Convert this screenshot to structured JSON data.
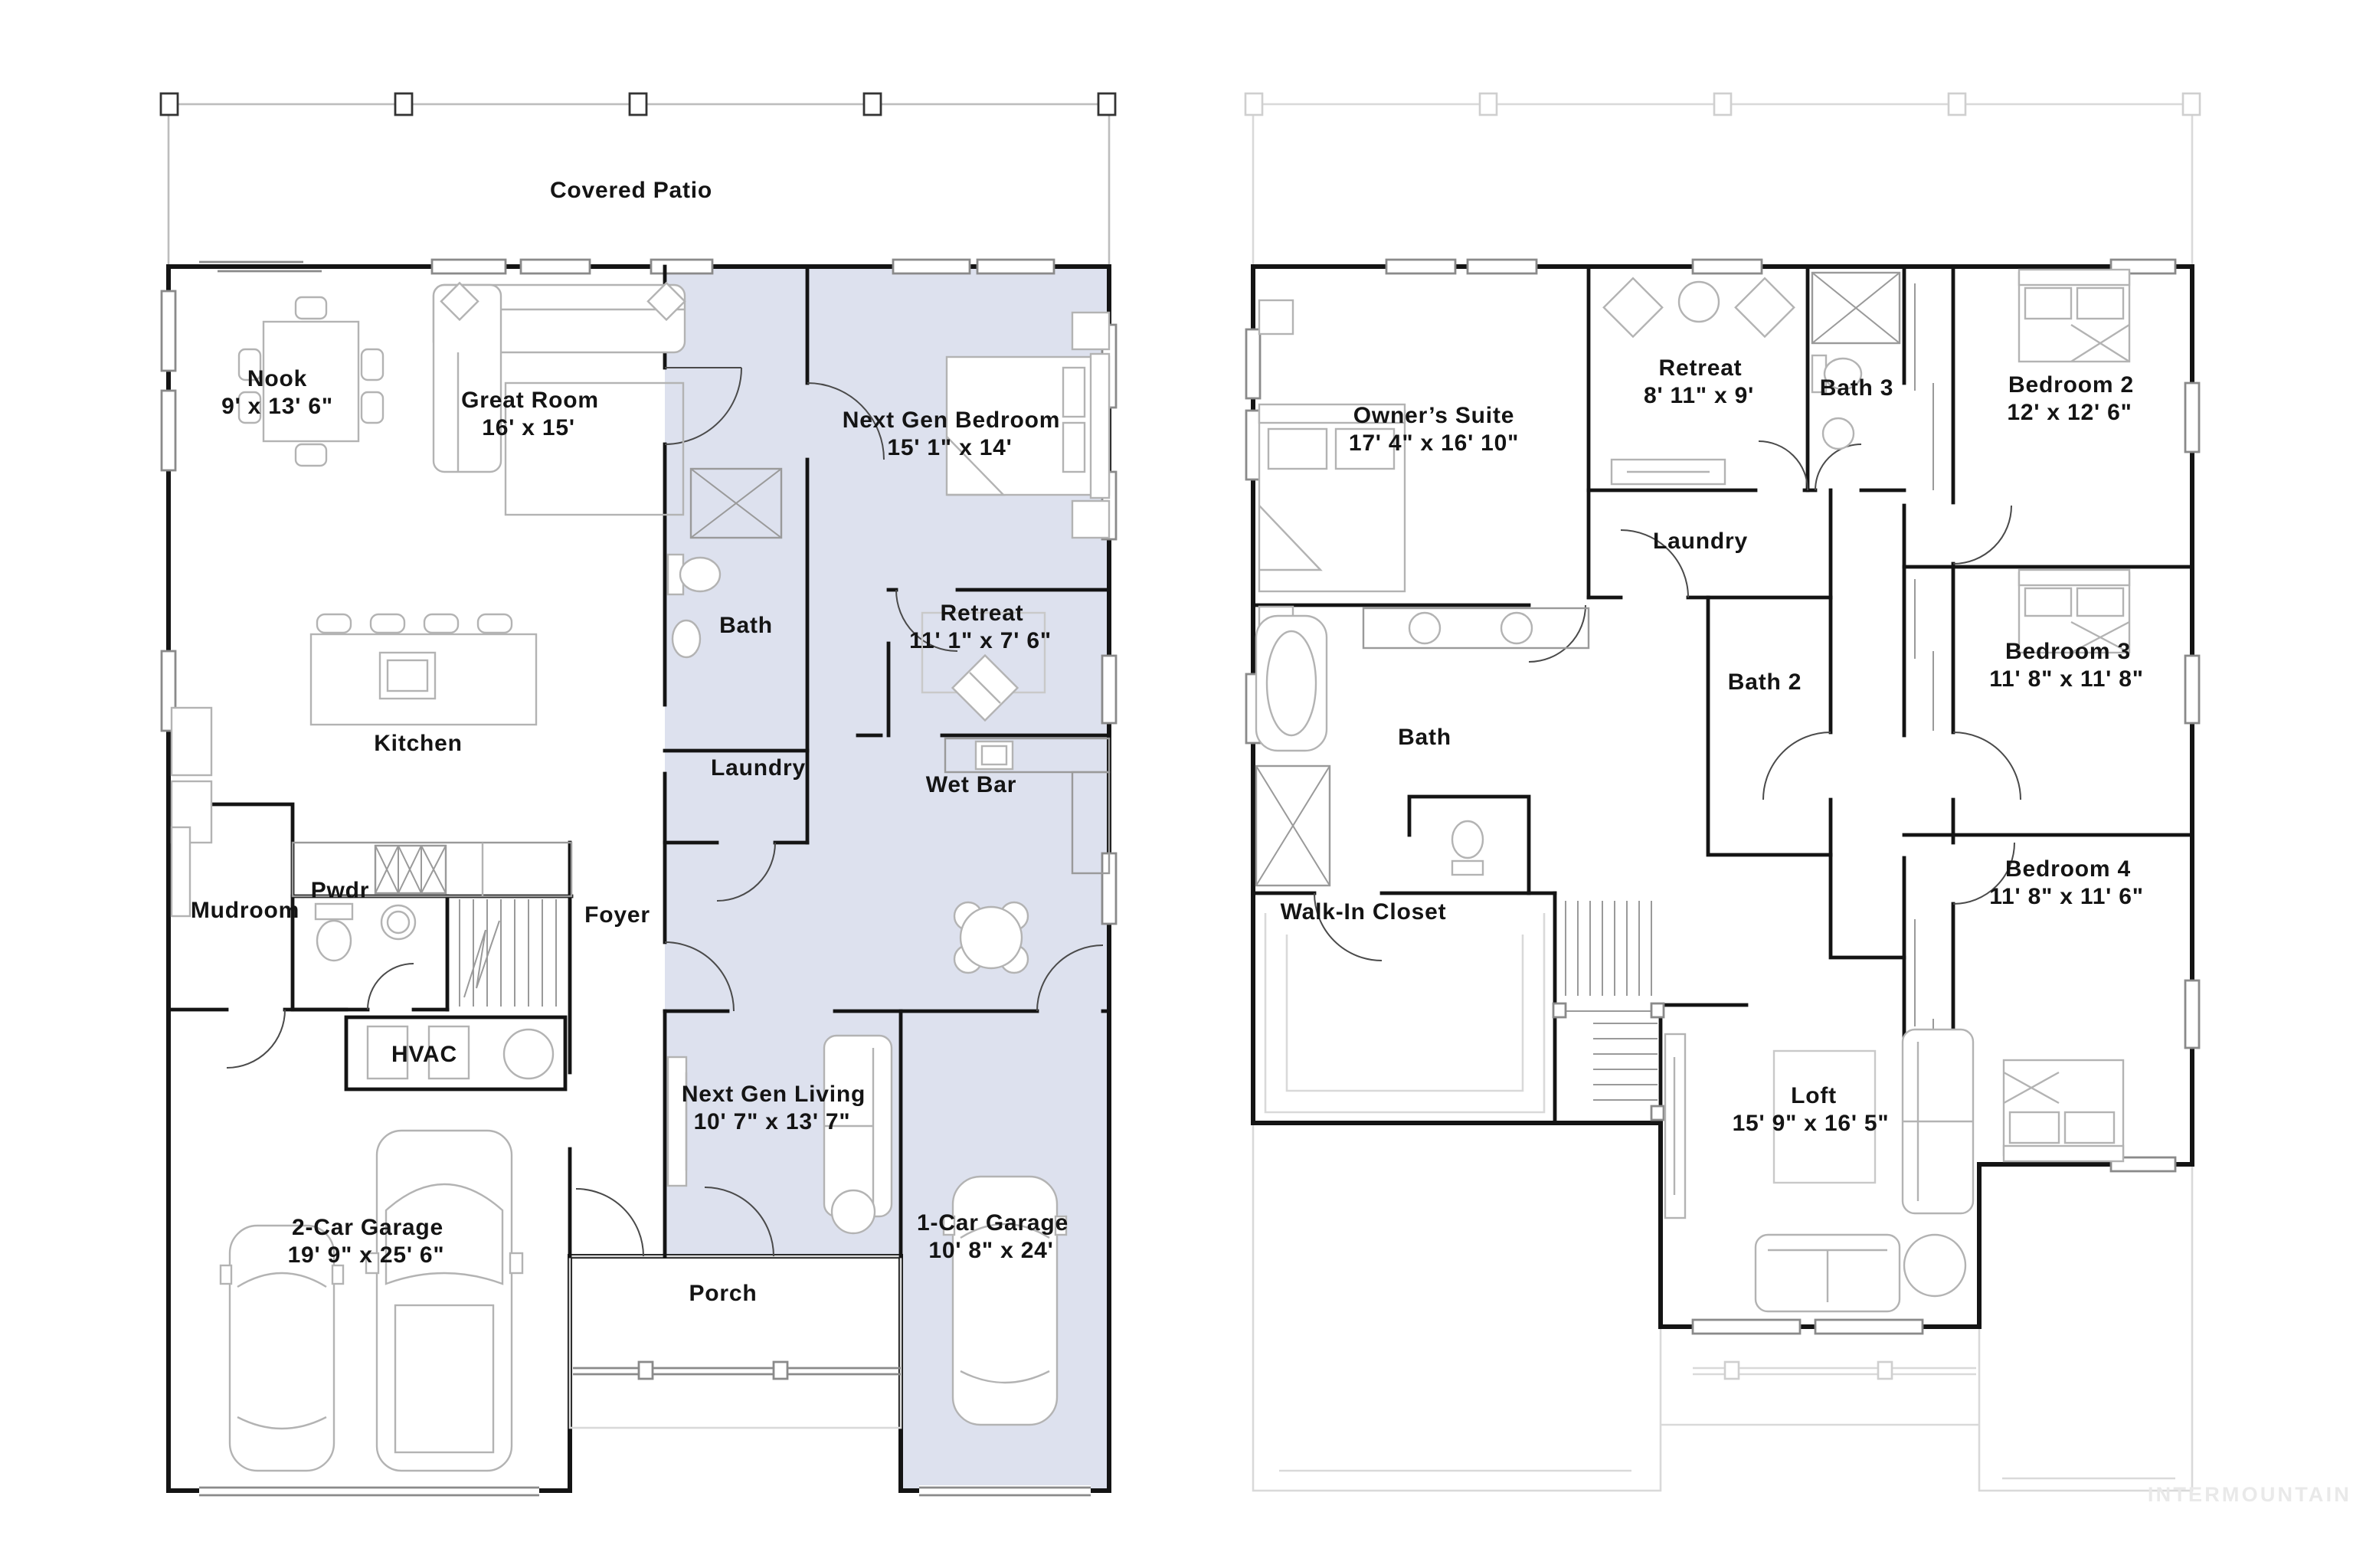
{
  "watermark": "INTERMOUNTAIN",
  "colors": {
    "highlight": "#dde1ee",
    "wall": "#141414",
    "furniture": "#b3b3b3",
    "ghost": "#d9d9d9",
    "watermark": "#e9e9e9"
  },
  "floor1": {
    "patio_label": "Covered Patio",
    "porch_label": "Porch",
    "rooms": {
      "nook": {
        "name": "Nook",
        "dims": "9' x 13' 6\""
      },
      "great_room": {
        "name": "Great Room",
        "dims": "16' x 15'"
      },
      "next_gen_bedroom": {
        "name": "Next Gen Bedroom",
        "dims": "15' 1\" x 14'"
      },
      "bath": {
        "name": "Bath"
      },
      "retreat": {
        "name": "Retreat",
        "dims": "11' 1\" x 7' 6\""
      },
      "laundry": {
        "name": "Laundry"
      },
      "wet_bar": {
        "name": "Wet Bar"
      },
      "kitchen": {
        "name": "Kitchen"
      },
      "pwdr": {
        "name": "Pwdr"
      },
      "mudroom": {
        "name": "Mudroom"
      },
      "foyer": {
        "name": "Foyer"
      },
      "hvac": {
        "name": "HVAC"
      },
      "garage2": {
        "name": "2-Car Garage",
        "dims": "19' 9\" x 25' 6\""
      },
      "next_gen_living": {
        "name": "Next Gen Living",
        "dims": "10' 7\" x 13' 7\""
      },
      "garage1": {
        "name": "1-Car Garage",
        "dims": "10' 8\" x 24'"
      }
    }
  },
  "floor2": {
    "rooms": {
      "owners_suite": {
        "name": "Owner’s Suite",
        "dims": "17' 4\" x 16' 10\""
      },
      "retreat": {
        "name": "Retreat",
        "dims": "8' 11\" x 9'"
      },
      "bath3": {
        "name": "Bath 3"
      },
      "bedroom2": {
        "name": "Bedroom 2",
        "dims": "12' x 12' 6\""
      },
      "laundry": {
        "name": "Laundry"
      },
      "bath": {
        "name": "Bath"
      },
      "bath2": {
        "name": "Bath 2"
      },
      "bedroom3": {
        "name": "Bedroom 3",
        "dims": "11' 8\" x 11' 8\""
      },
      "walk_in_closet": {
        "name": "Walk-In Closet"
      },
      "bedroom4": {
        "name": "Bedroom 4",
        "dims": "11' 8\" x 11' 6\""
      },
      "loft": {
        "name": "Loft",
        "dims": "15' 9\" x 16' 5\""
      }
    }
  }
}
